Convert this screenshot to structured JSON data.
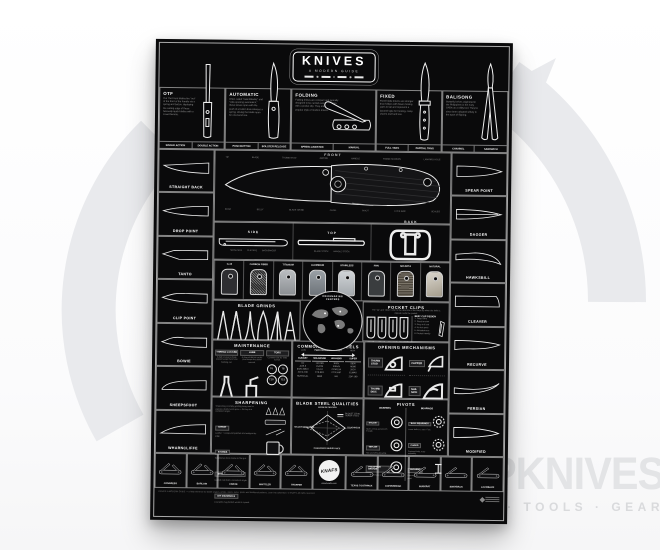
{
  "watermark": {
    "brand": "GPKNIVES",
    "tagline": "KNIVES · TOOLS · GEAR",
    "color": "#e3e4e6"
  },
  "poster": {
    "title": "KNIVES",
    "subtitle": "A MODERN GUIDE",
    "colors": {
      "bg": "#0a0a0b",
      "line": "#f0f0f0"
    },
    "types": [
      {
        "name": "OTF",
        "shape": "otf",
        "desc": "Out The Front blades fire \"out\" of the front of the handle via a spring and button, deploying the cutting edge of these famously quick blades with a crowd favorite.",
        "tags": [
          "SINGLE ACTION",
          "DOUBLE ACTION"
        ]
      },
      {
        "name": "AUTOMATIC",
        "shape": "auto",
        "desc": "Often called \"switchblades\" and \"side-opening automatics,\" these knives open with the push of a button that releases a spring, driving the blade open for one-hand use.",
        "tags": [
          "PUSH BUTTON",
          "BOLSTER RELEASE"
        ]
      },
      {
        "name": "FOLDING",
        "shape": "folding",
        "desc": "Folding knives are compact and typically designed to be carried every day, often with a pocket clip. They are the most popular style of modern knives.",
        "tags": [
          "SPRING ASSISTED",
          "MANUAL"
        ]
      },
      {
        "name": "FIXED",
        "shape": "fixed",
        "desc": "Fixed blade knives are stronger than folders with fewer moving parts to fail and represent a favored style for hunting, camp chores and hard use.",
        "tags": [
          "FULL TANG",
          "PARTIAL TANG"
        ]
      },
      {
        "name": "BALISONG",
        "shape": "balisong",
        "desc": "Butterfly knives originated in the Philippines in the early 1900s as a utility tool. They've since been adopted widely in the sport of flipping.",
        "tags": [
          "CHANNEL",
          "SANDWICH"
        ]
      }
    ],
    "views": {
      "front": "FRONT",
      "items": [
        {
          "label": "SIDE",
          "shape": "view-side",
          "notes": [
            "SHOW SIDE",
            "CLIP SIDE",
            "BACKSPACER"
          ]
        },
        {
          "label": "TOP",
          "shape": "view-top",
          "notes": [
            "BLADE STOCK",
            "HANDLE STOCK"
          ]
        },
        {
          "label": "BACK",
          "shape": "view-back",
          "notes": [
            "CLIP SCREWS",
            "POCKET CLIP"
          ]
        }
      ]
    },
    "anatomy": {
      "front_top": [
        "TIP",
        "BLADE",
        "THUMB STUD",
        "JIMPING",
        "HANDLE",
        "FRAME SCREWS",
        "LANYARD HOLE"
      ],
      "front_bottom": [
        "EDGE",
        "BELLY",
        "BLADE GRIND",
        "CHOIL",
        "PIVOT",
        "LOCK BAR",
        "SCALES"
      ]
    },
    "handles": [
      "G-10",
      "CARBON FIBER",
      "TITANIUM",
      "ALUMINUM",
      "STAINLESS",
      "FRN",
      "MICARTA",
      "NATURAL"
    ],
    "blade_shapes_left": [
      {
        "label": "STRAIGHT BACK",
        "shape": "straight-back"
      },
      {
        "label": "DROP POINT",
        "shape": "drop-point"
      },
      {
        "label": "TANTO",
        "shape": "tanto"
      },
      {
        "label": "CLIP POINT",
        "shape": "clip-point"
      },
      {
        "label": "BOWIE",
        "shape": "bowie"
      },
      {
        "label": "SHEEPSFOOT",
        "shape": "sheepsfoot"
      },
      {
        "label": "WHARNCLIFFE",
        "shape": "wharncliffe"
      }
    ],
    "blade_shapes_right": [
      {
        "label": "SPEAR POINT",
        "shape": "spear-point"
      },
      {
        "label": "DAGGER",
        "shape": "dagger"
      },
      {
        "label": "HAWKSBILL",
        "shape": "hawksbill"
      },
      {
        "label": "CLEAVER",
        "shape": "cleaver"
      },
      {
        "label": "RECURVE",
        "shape": "recurve"
      },
      {
        "label": "PERSIAN",
        "shape": "persian"
      },
      {
        "label": "MODIFIED",
        "shape": "modified"
      }
    ],
    "grinds": {
      "title": "BLADE GRINDS",
      "items": [
        {
          "label": "FLAT",
          "shape": "grind-flat"
        },
        {
          "label": "SCANDI",
          "shape": "grind-scandi"
        },
        {
          "label": "HOLLOW",
          "shape": "grind-hollow"
        },
        {
          "label": "CONVEX",
          "shape": "grind-convex"
        },
        {
          "label": "CHISEL",
          "shape": "grind-chisel"
        },
        {
          "label": "COMPOUND",
          "shape": "grind-compound"
        }
      ]
    },
    "map": {
      "line1": "KNIFEMAKING",
      "line2": "CENTERS"
    },
    "pocket_clips": {
      "title": "POCKET CLIPS",
      "desc": "The \"up\" and \"down\" refer to the direction of the blade tip when the knife is clipped inside the pocket.",
      "types": [
        "TIP-UP RIGHT",
        "TIP-UP LEFT",
        "TIP-DOWN RIGHT",
        "TIP-DOWN LEFT"
      ],
      "list_title": "BEST CLIP DESIGN",
      "list": [
        "1. Deep carry",
        "2. Good tension",
        "3. Easy in & out",
        "4. No hot spots",
        "5. Ambidextrous",
        "6. Pocket friendly"
      ]
    },
    "maintenance": {
      "title": "MAINTENANCE",
      "items": [
        {
          "name": "THREAD LOCKER",
          "desc": "A dab on pivot & body screws keeps them from backing out.",
          "icon": "bottle-a",
          "sizes": []
        },
        {
          "name": "LUBE",
          "desc": "A drop of thin oil on the pivot keeps the action smooth.",
          "icon": "bottle-b",
          "sizes": []
        },
        {
          "name": "TORX",
          "desc": "Common bits for knife screws.",
          "icon": "",
          "sizes": [
            "T6",
            "T8",
            "T10",
            "T15"
          ]
        }
      ]
    },
    "steels": {
      "title": "COMMON BLADE STEELS",
      "axis": "PERFORMANCE & COST",
      "low": "LOW",
      "high": "HIGH",
      "columns": [
        {
          "header": "BUDGET",
          "items": [
            "D2",
            "AUS-8",
            "8CR13MOV",
            "420 & 440",
            "SURGICAL"
          ]
        },
        {
          "header": "MID-RANGE",
          "items": [
            "14C28N",
            "154CM",
            "VG-10",
            "CTS-BD1",
            "N690"
          ]
        },
        {
          "header": "HIGH-END",
          "items": [
            "S30V",
            "S35VN",
            "CPM-154",
            "CTS-XHP",
            "M4"
          ]
        },
        {
          "header": "SUPER",
          "items": [
            "S90V",
            "M390",
            "20CV",
            "ELMAX",
            "ZDP-189"
          ]
        }
      ]
    },
    "opening": {
      "title": "OPENING MECHANISMS",
      "items": [
        {
          "label": "THUMB STUD",
          "icon": "mech-stud"
        },
        {
          "label": "FLIPPER",
          "icon": "mech-flipper"
        },
        {
          "label": "THUMB DISC",
          "icon": "mech-disc"
        },
        {
          "label": "NAIL NICK",
          "icon": "mech-nick"
        },
        {
          "label": "THUMB HOLE",
          "icon": "mech-hole"
        },
        {
          "label": "BUTTON",
          "icon": "mech-button"
        }
      ]
    },
    "sharpening": {
      "title": "SHARPENING",
      "intro": "Sharpening is simply grinding away steel to expose a fresh, keen apex — the key is a consistent angle.",
      "items": [
        {
          "name": "STROP",
          "desc": "Leather + compound polishes and realigns the edge."
        },
        {
          "name": "STONES",
          "desc": "Whetstones from coarse to fine grit."
        },
        {
          "name": "SHARPENING SYSTEM",
          "desc": "Guided rods hold a consistent angle."
        },
        {
          "name": "DIY MATERIALS",
          "desc": "A ceramic mug bottom works in a pinch."
        }
      ]
    },
    "qualities": {
      "title": "BLADE STEEL QUALITIES",
      "axes": [
        "EDGE RETENTION",
        "TOUGHNESS",
        "CORROSION RESISTANCE",
        "SHARPENING EASE"
      ],
      "legend": [
        "BUDGET STEEL",
        "SUPER STEEL"
      ]
    },
    "pivots": {
      "title": "PIVOTS",
      "groups": [
        {
          "header": "WASHERS",
          "items": [
            {
              "name": "NYLON",
              "desc": "Quiet, cheap and smooth enough.",
              "icon": "ring"
            },
            {
              "name": "TEFLON",
              "desc": "Thin and self-lubricating.",
              "icon": "ring"
            },
            {
              "name": "PHOSPHOR BRONZE",
              "desc": "Durable; breaks in smooth.",
              "icon": "ring"
            }
          ]
        },
        {
          "header": "BEARINGS",
          "items": [
            {
              "name": "BALL BEARINGS",
              "desc": "Loose balls in a race. Fast.",
              "icon": "ring-caged"
            },
            {
              "name": "CAGED",
              "desc": "Captured balls, easy assembly.",
              "icon": "ring-caged"
            },
            {
              "name": "BUSHING",
              "desc": "Free-spinning, drop-shut pivot.",
              "icon": "bushing"
            }
          ]
        }
      ]
    },
    "patterns": {
      "left": [
        "CONGRESS",
        "BARLOW",
        "CANOE",
        "WHITTLER",
        "TRAPPER"
      ],
      "right": [
        "TEXAS TOOTHPICK",
        "COPPERHEAD",
        "MUSKRAT",
        "SWAYBACK",
        "LOCKBACK"
      ],
      "badge": {
        "brand": "KNAFS",
        "url": "www.knafs.com"
      }
    },
    "fine_print": "KNIVES: A MODERN GUIDE — a field reference for blade shapes, grinds, steels, locks, pivots and traditional patterns. Lean into adventure.",
    "fine_print2": "© KNAFS. All rights reserved."
  }
}
